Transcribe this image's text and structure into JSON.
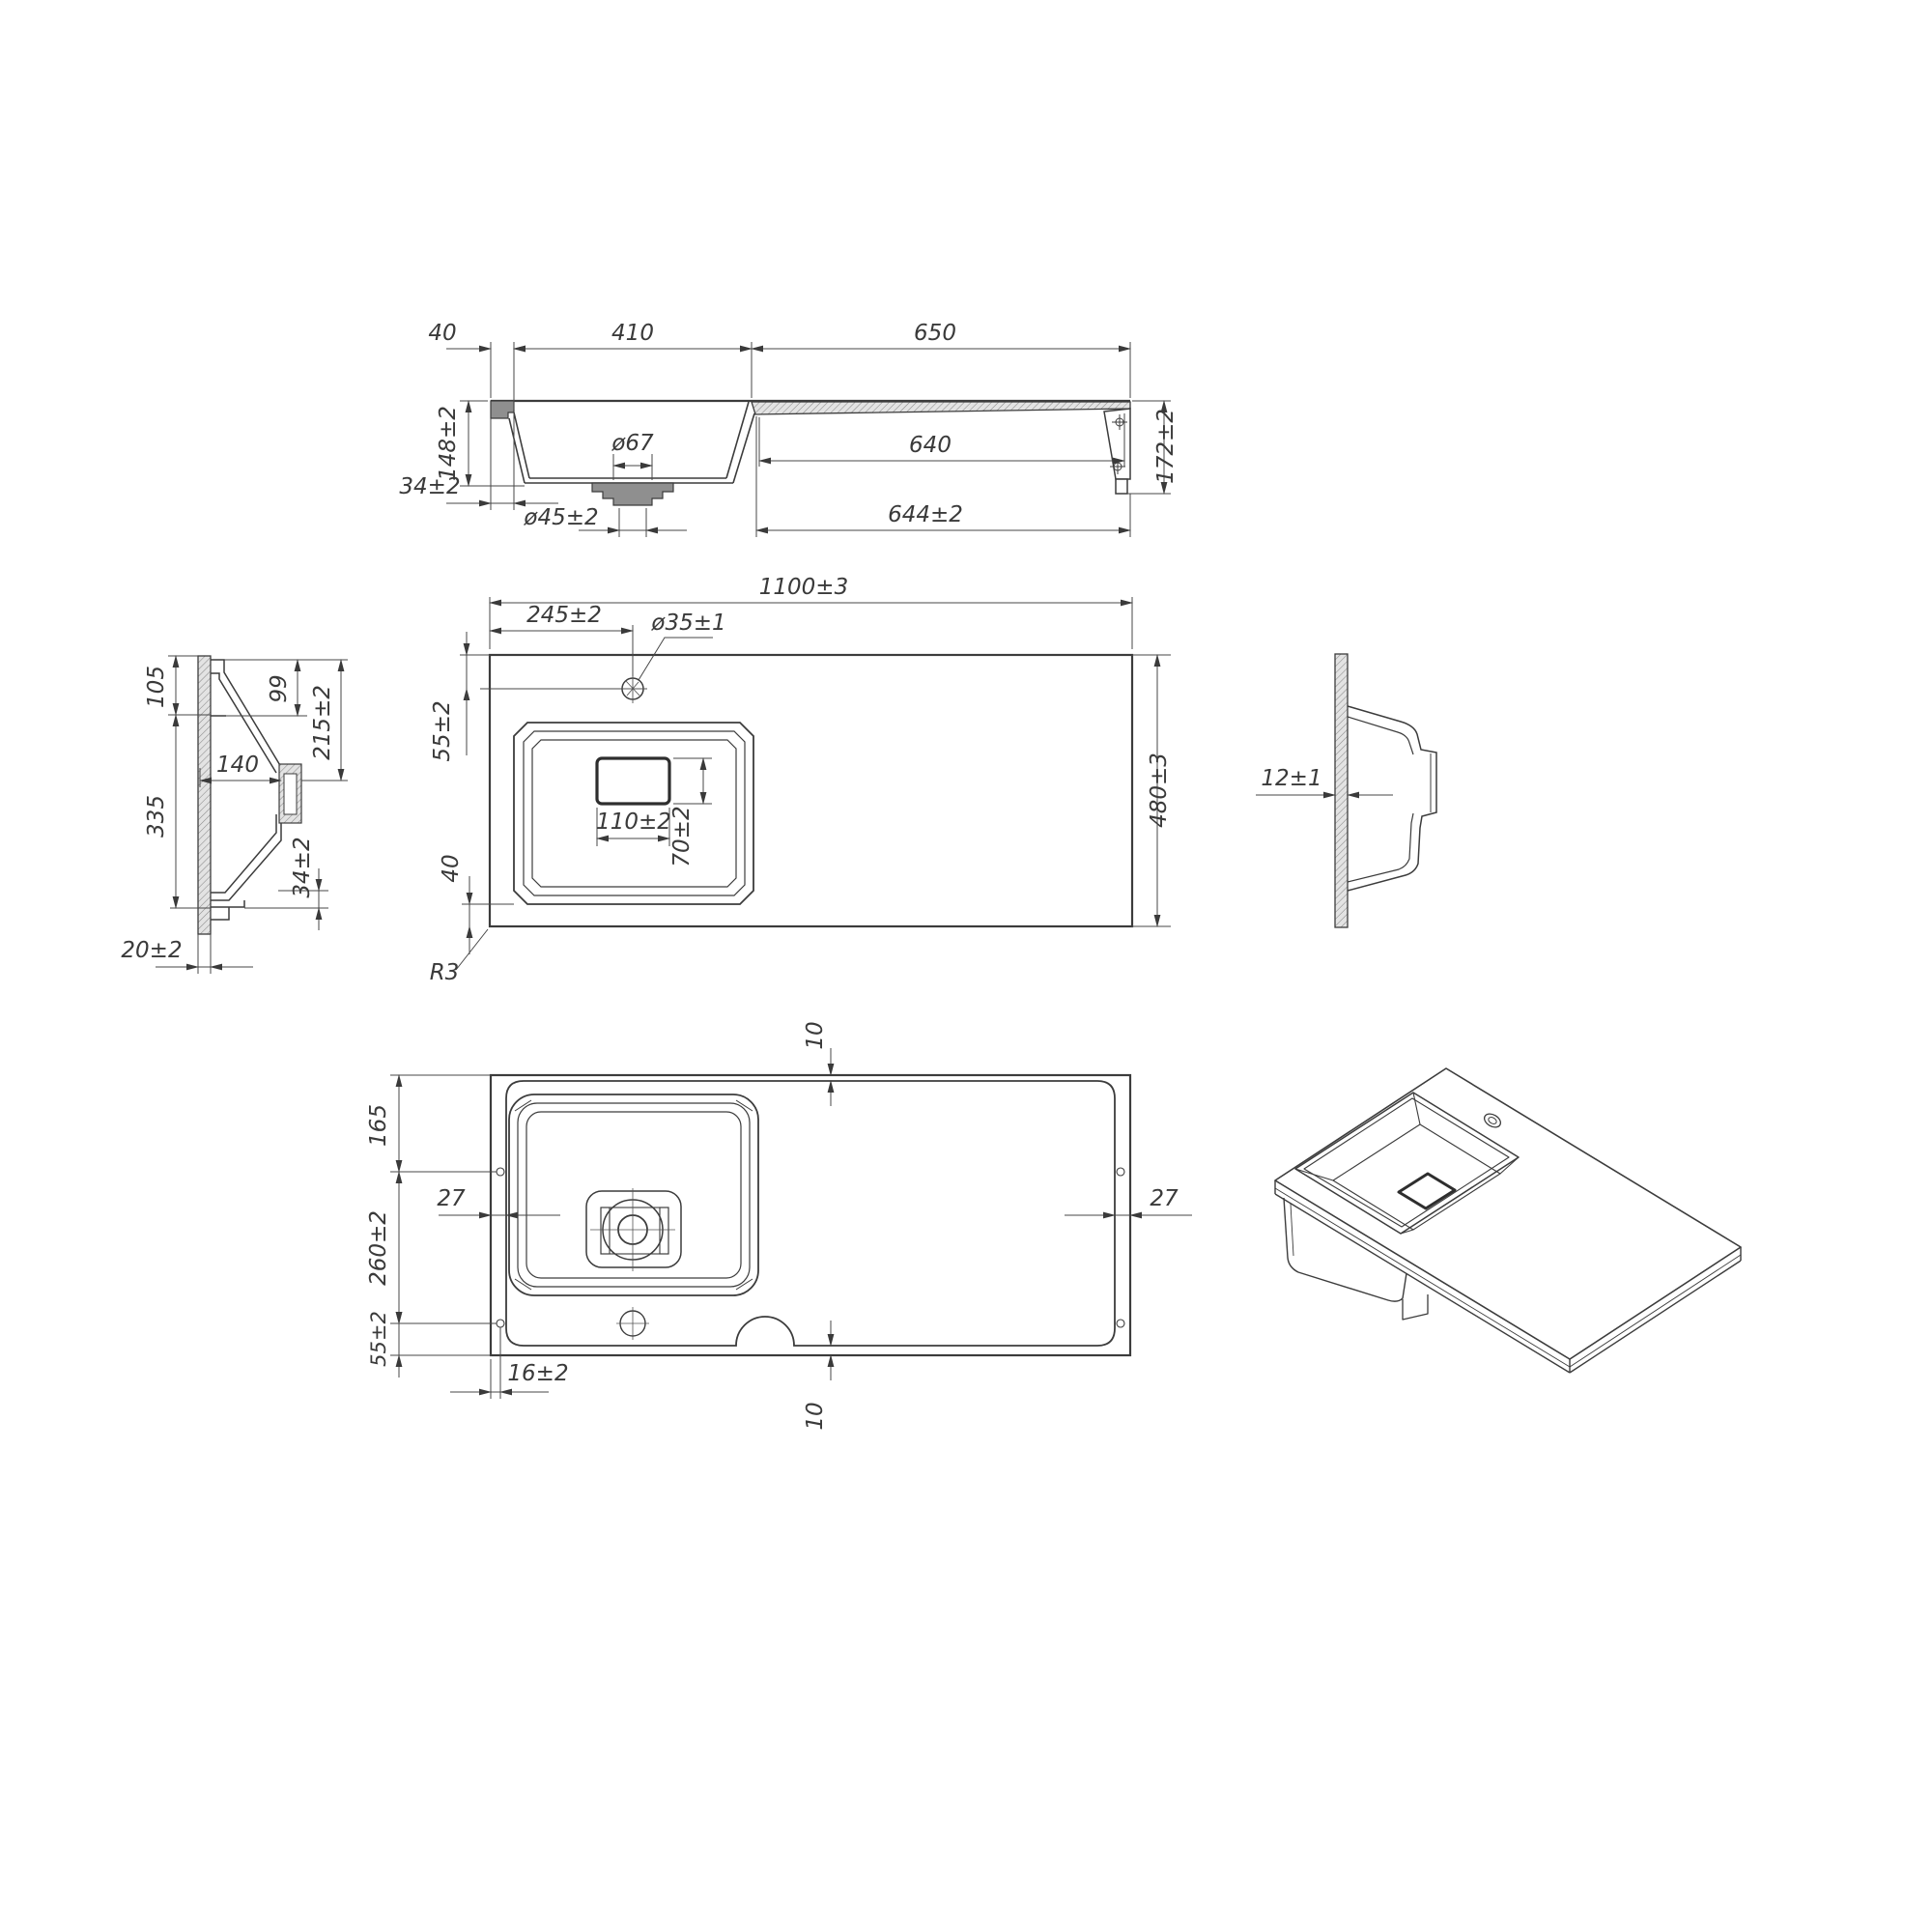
{
  "drawing_type": "technical-cad-drawing",
  "product": "kitchen-sink-with-drainboard",
  "colors": {
    "background": "#ffffff",
    "line": "#3c3c3c",
    "dimension_line": "#474747",
    "text": "#3a3a3a",
    "hatch": "#8a8a8a"
  },
  "views": {
    "front": {
      "title": "front-section-view",
      "dims": {
        "d40": "40",
        "d410": "410",
        "d650": "650",
        "d148": "148±2",
        "d34": "34±2",
        "d67": "ø67",
        "d45": "ø45±2",
        "d640": "640",
        "d644": "644±2",
        "d172": "172±2"
      }
    },
    "side_left": {
      "title": "left-side-section-view",
      "dims": {
        "d105": "105",
        "d99": "99",
        "d215": "215±2",
        "d140": "140",
        "d335": "335",
        "d34": "34±2",
        "d20": "20±2"
      }
    },
    "plan": {
      "title": "top-plan-view",
      "dims": {
        "d1100": "1100±3",
        "d245": "245±2",
        "d35": "ø35±1",
        "d55": "55±2",
        "d110": "110±2",
        "d70": "70±2",
        "d40": "40",
        "r3": "R3",
        "d480": "480±3"
      }
    },
    "side_right": {
      "title": "right-side-view",
      "dims": {
        "d12": "12±1"
      }
    },
    "bottom": {
      "title": "bottom-view",
      "dims": {
        "d10a": "10",
        "d165": "165",
        "d27a": "27",
        "d260": "260±2",
        "d55": "55±2",
        "d16": "16±2",
        "d10b": "10",
        "d27b": "27"
      }
    },
    "isometric": {
      "title": "isometric-view"
    }
  }
}
